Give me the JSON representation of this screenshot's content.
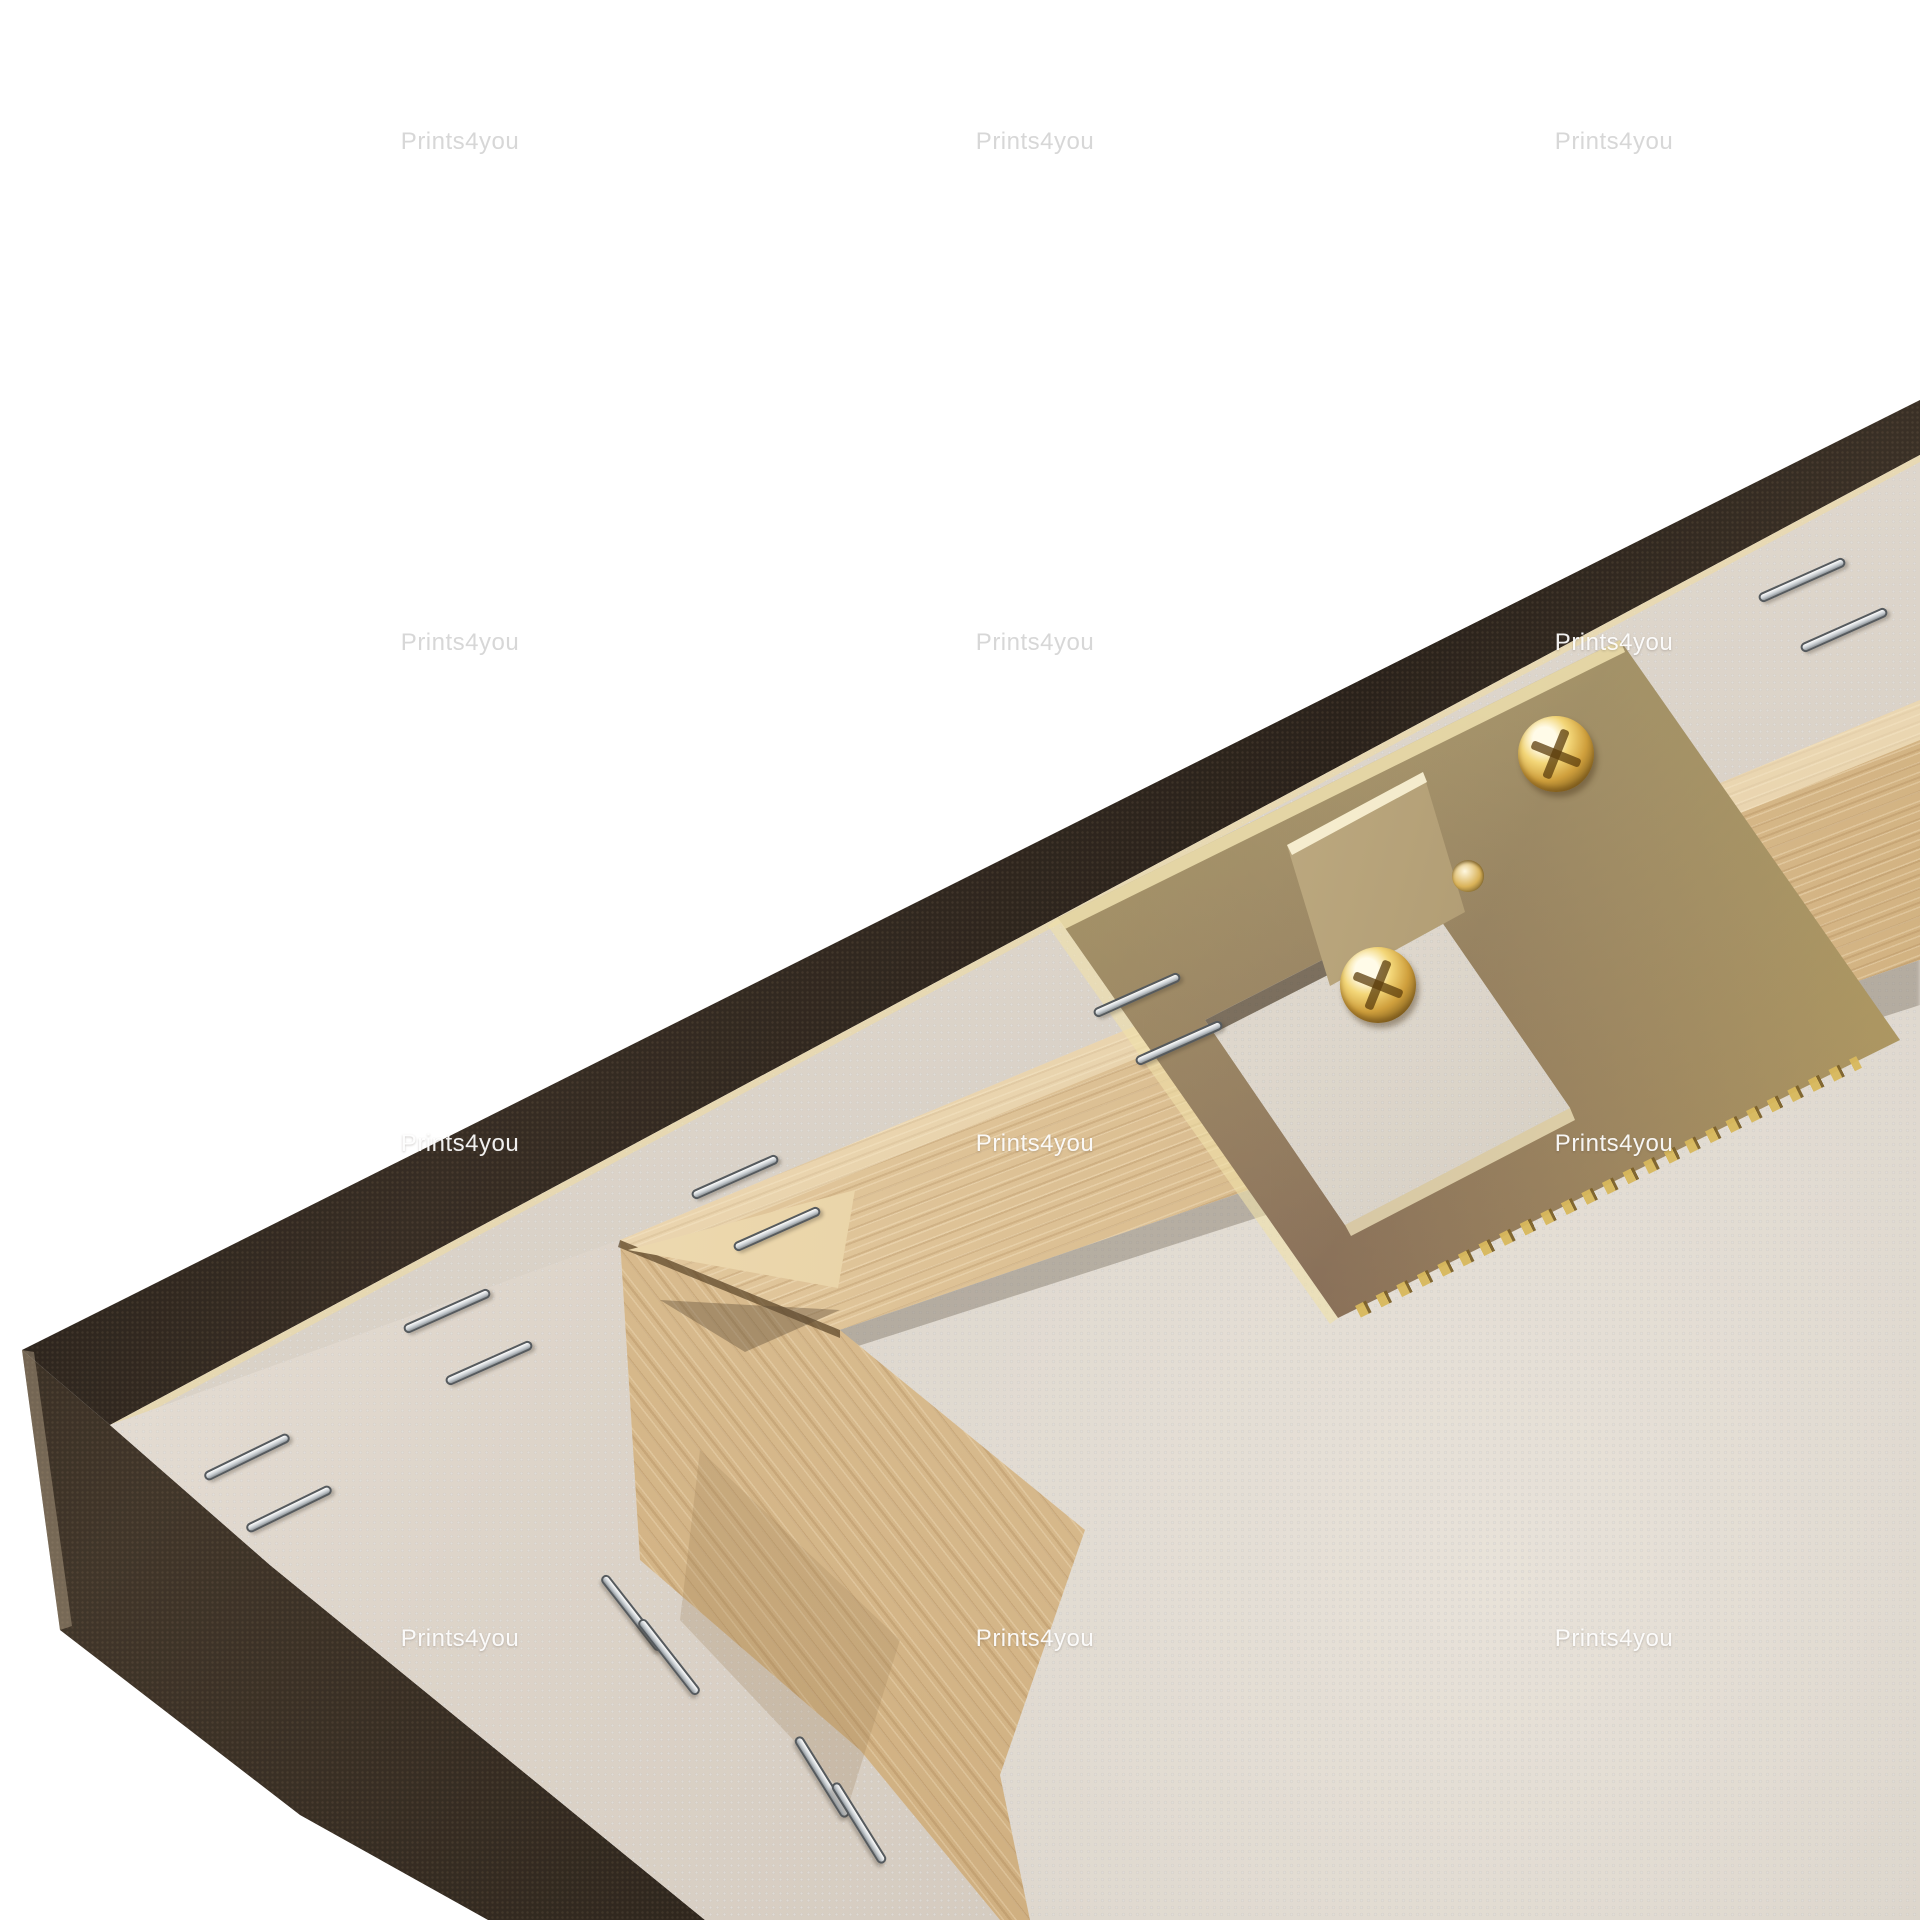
{
  "watermark": {
    "text": "Prints4you",
    "instances": [
      {
        "x": 460,
        "y": 142,
        "tone": "gray"
      },
      {
        "x": 1035,
        "y": 142,
        "tone": "gray"
      },
      {
        "x": 1614,
        "y": 142,
        "tone": "gray"
      },
      {
        "x": 460,
        "y": 643,
        "tone": "gray"
      },
      {
        "x": 1035,
        "y": 643,
        "tone": "gray"
      },
      {
        "x": 1614,
        "y": 643,
        "tone": "white"
      },
      {
        "x": 460,
        "y": 1144,
        "tone": "white"
      },
      {
        "x": 1035,
        "y": 1144,
        "tone": "white"
      },
      {
        "x": 1614,
        "y": 1144,
        "tone": "white"
      },
      {
        "x": 460,
        "y": 1639,
        "tone": "white"
      },
      {
        "x": 1035,
        "y": 1639,
        "tone": "white"
      },
      {
        "x": 1614,
        "y": 1639,
        "tone": "white"
      }
    ]
  },
  "hardware": {
    "screws": [
      {
        "x": 1378,
        "y": 985
      },
      {
        "x": 1556,
        "y": 754
      }
    ],
    "hole": {
      "x": 1468,
      "y": 876
    }
  },
  "staples": [
    {
      "x": 200,
      "y": 1452,
      "angle": -26
    },
    {
      "x": 242,
      "y": 1504,
      "angle": -26
    },
    {
      "x": 400,
      "y": 1306,
      "angle": -24
    },
    {
      "x": 442,
      "y": 1358,
      "angle": -24
    },
    {
      "x": 688,
      "y": 1172,
      "angle": -24
    },
    {
      "x": 730,
      "y": 1224,
      "angle": -24
    },
    {
      "x": 1090,
      "y": 990,
      "angle": -24
    },
    {
      "x": 1132,
      "y": 1038,
      "angle": -24
    },
    {
      "x": 1755,
      "y": 575,
      "angle": -24
    },
    {
      "x": 1797,
      "y": 625,
      "angle": -24
    },
    {
      "x": 585,
      "y": 1608,
      "angle": 52
    },
    {
      "x": 622,
      "y": 1652,
      "angle": 52
    },
    {
      "x": 775,
      "y": 1772,
      "angle": 58
    },
    {
      "x": 812,
      "y": 1818,
      "angle": 58
    }
  ],
  "colors": {
    "background": "#ffffff",
    "canvas_edge_dark": "#32291f",
    "canvas_back": "#ddd5cb",
    "wood_light": "#eed8b0",
    "wood_shadow": "#c9a878",
    "metal_brass": "#b29a5e",
    "screw_gold": "#d8b85c",
    "staple_silver": "#c6cbcf"
  }
}
